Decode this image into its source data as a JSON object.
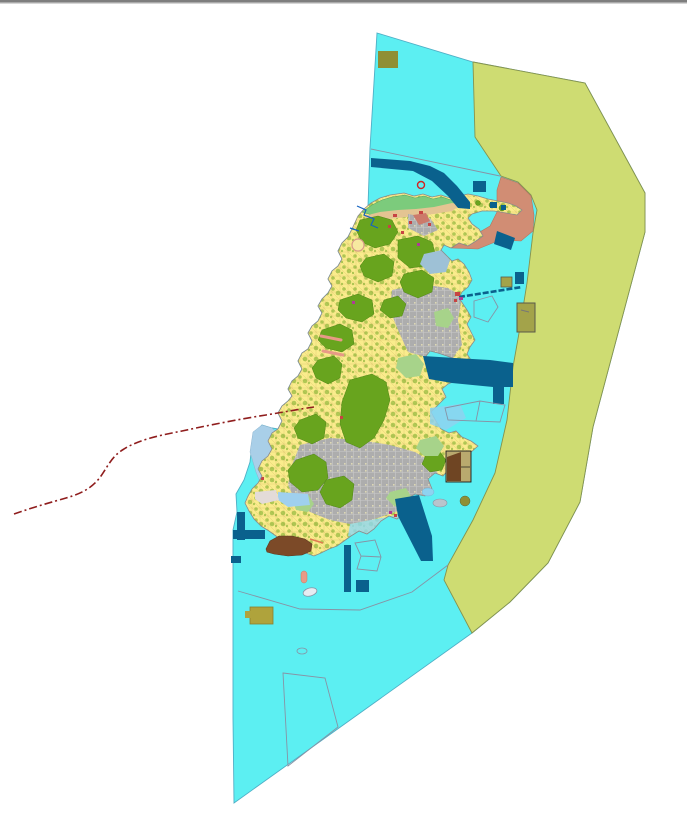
{
  "window": {
    "top_divider": {
      "primary": "#7E7E7E",
      "highlight": "#D6D6D6"
    }
  },
  "palette": {
    "cyan": "#5CEFF2",
    "cyanEdge": "#4FAFC6",
    "yellowGreen": "#CEDC72",
    "yellowGreenEdge": "#85924D",
    "islandYellow": "#FAEC8C",
    "parcelLine": "#DCC46F",
    "olive": "#68A41E",
    "oliveEdge": "#4F8516",
    "brightGreen": "#7CCB7C",
    "sand": "#E4C492",
    "urbanGray": "#ADADAD",
    "urbanLight": "#C9C9C9",
    "lightGreen": "#A7D38A",
    "lightBlue": "#8ED2F0",
    "paleBlue": "#A9CFE8",
    "blueGray": "#9EC1D6",
    "navy": "#0A618D",
    "salmon": "#D18D74",
    "salmonLight": "#E79A86",
    "khaki": "#A3A34A",
    "khakiDark": "#8F8F35",
    "mustard": "#AFA33C",
    "brown": "#7C4A28",
    "brownDark": "#6F4523",
    "tanKhaki": "#B9A96E",
    "darkRed": "#8F1D1D",
    "crimson": "#C74343",
    "magenta": "#B03A96",
    "streamBlue": "#1463C0",
    "outlineGray": "#8793A5",
    "coastGray": "#8A8A8A",
    "paleGray": "#E3DBD8",
    "white": "#FFFFFF"
  },
  "map": {
    "features": [
      {
        "name": "open-water-zone",
        "color_key": "cyan"
      },
      {
        "name": "outer-coastal-band-zone",
        "color_key": "yellowGreen"
      },
      {
        "name": "island-landmass-parcels",
        "color_key": "islandYellow"
      },
      {
        "name": "vegetation-parcel-clusters",
        "color_key": "olive"
      },
      {
        "name": "built-up-gray-parcels",
        "color_key": "urbanGray"
      },
      {
        "name": "north-shore-green-strip",
        "color_key": "brightGreen"
      },
      {
        "name": "north-shore-sand-strip",
        "color_key": "sand"
      },
      {
        "name": "northeast-developed-area",
        "color_key": "salmon"
      },
      {
        "name": "harbor-navy-structures",
        "color_key": "navy"
      },
      {
        "name": "khaki-facility-blocks",
        "color_key": "khaki"
      },
      {
        "name": "brown-reclaimed-areas",
        "color_key": "brown"
      },
      {
        "name": "dashed-offshore-boundary-line",
        "color_key": "darkRed"
      },
      {
        "name": "unfilled-survey-polygons",
        "color_key": "outlineGray"
      }
    ]
  }
}
